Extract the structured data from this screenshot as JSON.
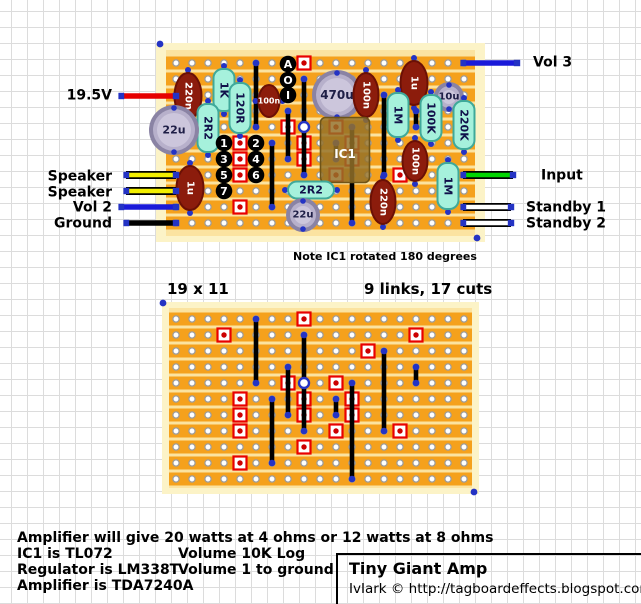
{
  "title_box": {
    "title": "Tiny Giant Amp",
    "credit": "IvIark © http://tagboardeffects.blogspot.com/"
  },
  "notes": {
    "ic_note": "Note IC1 rotated 180 degrees",
    "grid_size": "19 x 11",
    "links_cuts": "9 links, 17 cuts"
  },
  "footer": {
    "line1": "Amplifier will give 20 watts at 4 ohms or 12 watts at 8 ohms",
    "col1": [
      "IC1 is TL072",
      "Regulator is LM338T",
      "Amplifier is TDA7240A"
    ],
    "col2": [
      "Volume 10K Log",
      "Volume 1 to ground"
    ]
  },
  "io_labels": {
    "left": [
      {
        "name": "label-19-5v",
        "text": "19.5V",
        "x": 112,
        "y": 96
      },
      {
        "name": "label-speaker-1",
        "text": "Speaker",
        "x": 112,
        "y": 177
      },
      {
        "name": "label-speaker-2",
        "text": "Speaker",
        "x": 112,
        "y": 193
      },
      {
        "name": "label-vol-2",
        "text": "Vol 2",
        "x": 112,
        "y": 208
      },
      {
        "name": "label-ground",
        "text": "Ground",
        "x": 112,
        "y": 224
      }
    ],
    "right": [
      {
        "name": "label-vol-3",
        "text": "Vol 3",
        "x": 533,
        "y": 63
      },
      {
        "name": "label-input",
        "text": "Input",
        "x": 541,
        "y": 176
      },
      {
        "name": "label-standby-1",
        "text": "Standby 1",
        "x": 526,
        "y": 208
      },
      {
        "name": "label-standby-2",
        "text": "Standby 2",
        "x": 526,
        "y": 224
      }
    ]
  },
  "wires": [
    {
      "name": "wire-19-5v",
      "color": "#e60000",
      "outline": null,
      "x1": 121,
      "y": 96,
      "x2": 176
    },
    {
      "name": "wire-speaker-1",
      "color": "#f2ee00",
      "outline": "#000000",
      "x1": 126,
      "y": 175,
      "x2": 176
    },
    {
      "name": "wire-speaker-2",
      "color": "#f2ee00",
      "outline": "#000000",
      "x1": 126,
      "y": 191,
      "x2": 176
    },
    {
      "name": "wire-vol-2",
      "color": "#1a1ad9",
      "outline": null,
      "x1": 121,
      "y": 207,
      "x2": 176
    },
    {
      "name": "wire-ground",
      "color": "#000000",
      "outline": null,
      "x1": 126,
      "y": 223,
      "x2": 176
    },
    {
      "name": "wire-vol-3",
      "color": "#1a1ad9",
      "outline": null,
      "x1": 463,
      "y": 63,
      "x2": 517
    },
    {
      "name": "wire-input",
      "color": "#00d500",
      "outline": "#000000",
      "x1": 463,
      "y": 175,
      "x2": 513
    },
    {
      "name": "wire-standby-1",
      "color": "#ffffff",
      "outline": "#000000",
      "x1": 463,
      "y": 207,
      "x2": 511
    },
    {
      "name": "wire-standby-2",
      "color": "#ffffff",
      "outline": "#000000",
      "x1": 463,
      "y": 223,
      "x2": 511
    }
  ],
  "boards": {
    "cols": 19,
    "rows": 11,
    "pitch": 16,
    "top": {
      "x0": 176,
      "y0": 63,
      "frame": [
        156,
        43,
        329,
        199
      ],
      "orange": [
        166,
        50,
        309,
        186
      ],
      "corners": [
        [
          160,
          44
        ],
        [
          477,
          238
        ]
      ]
    },
    "bottom": {
      "x0": 176,
      "y0": 319,
      "frame": [
        162,
        302,
        317,
        192
      ],
      "orange": [
        169,
        308,
        303,
        180
      ],
      "corners": [
        [
          163,
          303
        ],
        [
          474,
          492
        ]
      ]
    }
  },
  "cuts": [
    [
      9,
      1
    ],
    [
      4,
      2
    ],
    [
      16,
      2
    ],
    [
      13,
      3
    ],
    [
      8,
      5
    ],
    [
      11,
      5
    ],
    [
      5,
      6
    ],
    [
      9,
      6
    ],
    [
      12,
      6
    ],
    [
      5,
      7
    ],
    [
      9,
      7
    ],
    [
      12,
      7
    ],
    [
      5,
      8
    ],
    [
      11,
      8
    ],
    [
      15,
      8
    ],
    [
      9,
      9
    ],
    [
      5,
      10
    ]
  ],
  "links": [
    [
      6,
      1,
      5
    ],
    [
      9,
      2,
      5
    ],
    [
      9,
      5,
      8
    ],
    [
      14,
      3,
      8
    ],
    [
      8,
      4,
      7
    ],
    [
      16,
      4,
      5
    ],
    [
      12,
      5,
      11
    ],
    [
      7,
      6,
      10
    ],
    [
      11,
      6,
      7
    ]
  ],
  "junction": [
    9,
    5
  ],
  "components": [
    {
      "name": "cap-220n-a",
      "label": "220n",
      "kind": "film",
      "cx": 188,
      "cy": 96,
      "w": 27,
      "h": 46,
      "vert": true
    },
    {
      "name": "res-1k",
      "label": "1K",
      "kind": "res",
      "cx": 224,
      "cy": 90,
      "w": 21,
      "h": 42,
      "vert": true
    },
    {
      "name": "res-120r",
      "label": "120R",
      "kind": "res",
      "cx": 240,
      "cy": 108,
      "w": 21,
      "h": 50,
      "vert": true
    },
    {
      "name": "res-2r2-a",
      "label": "2R2",
      "kind": "res",
      "cx": 208,
      "cy": 128,
      "w": 21,
      "h": 48,
      "vert": true
    },
    {
      "name": "cap-22u-a",
      "label": "22u",
      "kind": "ecap",
      "cx": 174,
      "cy": 130,
      "r": 25,
      "fs": 11
    },
    {
      "name": "cap-100n-a",
      "label": "100n",
      "kind": "film",
      "cx": 269,
      "cy": 101,
      "w": 21,
      "h": 32,
      "vert": false,
      "fs": 8
    },
    {
      "name": "cap-470u",
      "label": "470u",
      "kind": "ecap",
      "cx": 337,
      "cy": 95,
      "r": 25,
      "fs": 12
    },
    {
      "name": "cap-100n-b",
      "label": "100n",
      "kind": "film",
      "cx": 366,
      "cy": 95,
      "w": 25,
      "h": 44,
      "vert": true
    },
    {
      "name": "cap-1u-a",
      "label": "1u",
      "kind": "film",
      "cx": 414,
      "cy": 83,
      "w": 27,
      "h": 44,
      "vert": true
    },
    {
      "name": "res-1m-a",
      "label": "1M",
      "kind": "res",
      "cx": 398,
      "cy": 115,
      "w": 21,
      "h": 44,
      "vert": true
    },
    {
      "name": "cap-10u",
      "label": "10u",
      "kind": "ecap",
      "cx": 449,
      "cy": 97,
      "r": 15,
      "fs": 10
    },
    {
      "name": "res-100k",
      "label": "100K",
      "kind": "res",
      "cx": 431,
      "cy": 118,
      "w": 21,
      "h": 46,
      "vert": true
    },
    {
      "name": "res-220k",
      "label": "220K",
      "kind": "res",
      "cx": 464,
      "cy": 125,
      "w": 21,
      "h": 48,
      "vert": true
    },
    {
      "name": "ic1",
      "label": "IC1",
      "kind": "ic",
      "cx": 345,
      "cy": 150,
      "w": 49,
      "h": 65
    },
    {
      "name": "cap-100n-c",
      "label": "100n",
      "kind": "film",
      "cx": 415,
      "cy": 161,
      "w": 25,
      "h": 40,
      "vert": true
    },
    {
      "name": "res-1m-b",
      "label": "1M",
      "kind": "res",
      "cx": 448,
      "cy": 186,
      "w": 21,
      "h": 46,
      "vert": true
    },
    {
      "name": "cap-1u-b",
      "label": "1u",
      "kind": "film",
      "cx": 190,
      "cy": 188,
      "w": 27,
      "h": 44,
      "vert": true
    },
    {
      "name": "res-2r2-b",
      "label": "2R2",
      "kind": "res",
      "cx": 311,
      "cy": 190,
      "w": 46,
      "h": 17,
      "vert": false
    },
    {
      "name": "cap-22u-b",
      "label": "22u",
      "kind": "ecap",
      "cx": 303,
      "cy": 215,
      "r": 17,
      "fs": 10
    },
    {
      "name": "cap-220n-b",
      "label": "220n",
      "kind": "film",
      "cx": 383,
      "cy": 202,
      "w": 25,
      "h": 44,
      "vert": true
    }
  ],
  "pins": [
    {
      "name": "pad-a",
      "label": "A",
      "cx": 288,
      "cy": 64
    },
    {
      "name": "pad-o",
      "label": "O",
      "cx": 288,
      "cy": 80
    },
    {
      "name": "pad-i",
      "label": "I",
      "cx": 288,
      "cy": 95
    },
    {
      "name": "pad-1",
      "label": "1",
      "cx": 224,
      "cy": 143
    },
    {
      "name": "pad-2",
      "label": "2",
      "cx": 256,
      "cy": 143
    },
    {
      "name": "pad-3",
      "label": "3",
      "cx": 224,
      "cy": 159
    },
    {
      "name": "pad-4",
      "label": "4",
      "cx": 256,
      "cy": 159
    },
    {
      "name": "pad-5",
      "label": "5",
      "cx": 224,
      "cy": 175
    },
    {
      "name": "pad-6",
      "label": "6",
      "cx": 256,
      "cy": 175
    },
    {
      "name": "pad-7",
      "label": "7",
      "cx": 224,
      "cy": 191
    }
  ],
  "colors": {
    "board": "#fcf3c7",
    "strip": "#f5a11c",
    "gap": "#fbe3a0",
    "hole_fill": "#ffffff",
    "hole_ring": "#9c9c9c",
    "cut_border": "#e80000",
    "cut_dot": "#cc0000",
    "link": "#000000",
    "dot": "#2433c4",
    "res_fill": "#a6f1dc",
    "res_border": "#3fa99a",
    "res_text": "#10104a",
    "film_fill": "#8c1c0c",
    "film_border": "#6b1005",
    "film_text": "#ffffff",
    "ecap_ring": "#8a83a4",
    "ecap_mid": "#b7b0cb",
    "ecap_face": "#ccc6dc",
    "ecap_text": "#1e1e46",
    "ic_fill": "rgba(148,113,41,0.84)",
    "ic_border": "#6f5417",
    "ic_text": "#ffffff",
    "pad_fill": "#000000",
    "pad_text": "#ffffff"
  }
}
